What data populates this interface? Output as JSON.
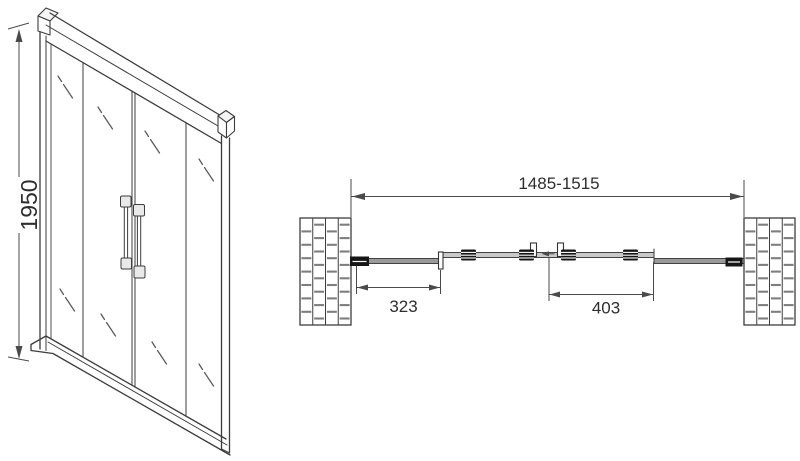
{
  "drawing": {
    "colors": {
      "background": "#ffffff",
      "line": "#3d3d3d",
      "dimension_line": "#4a4a4a",
      "text": "#2e2e2e",
      "dark_fill": "#161616"
    },
    "front_view": {
      "height_dim_label": "1950"
    },
    "plan_view": {
      "overall_width_dim_label": "1485-1515",
      "left_panel_dim_label": "323",
      "door_panel_dim_label": "403"
    }
  }
}
